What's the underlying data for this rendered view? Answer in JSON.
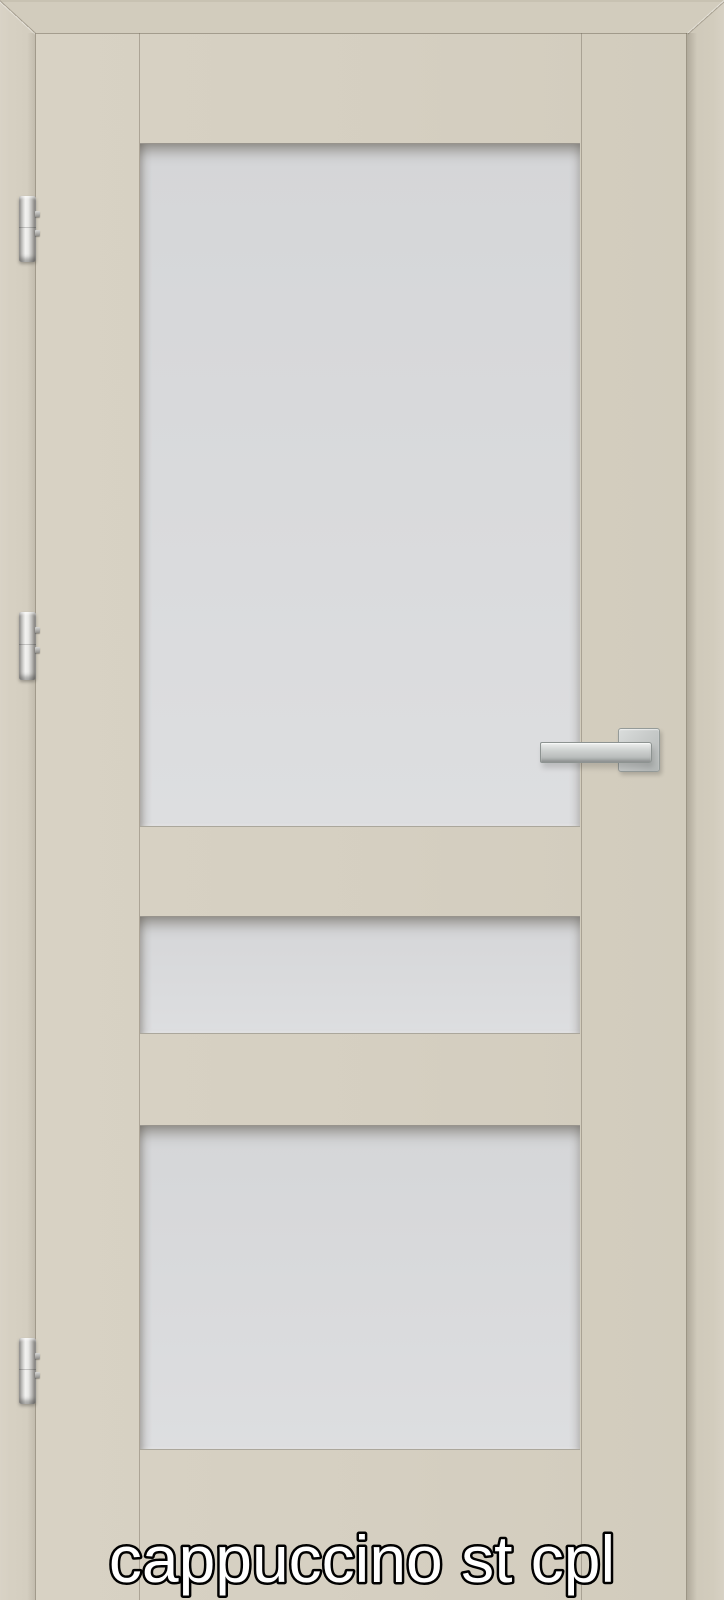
{
  "label": {
    "text": "cappuccino st cpl"
  },
  "product": {
    "finish_name": "cappuccino",
    "variant_code": "st cpl",
    "description": "interior door with frame, three frosted glass panels",
    "glass_panel_count": 3,
    "hinge_count": 3
  },
  "colors": {
    "door_face": "#d5cec0",
    "frame_top": "#d2ccbd",
    "frame_left": "#d6d0c2",
    "frame_right": "#d0cabb",
    "glass": "#d9dadc",
    "metal_hardware": "#c9cccb",
    "joint_line": "#8f8675",
    "label_fill": "#ffffff",
    "label_outline": "#000000"
  },
  "hinges": [
    "top",
    "middle",
    "bottom"
  ],
  "handle": {
    "style": "square rosette lever",
    "finish": "brushed steel"
  }
}
